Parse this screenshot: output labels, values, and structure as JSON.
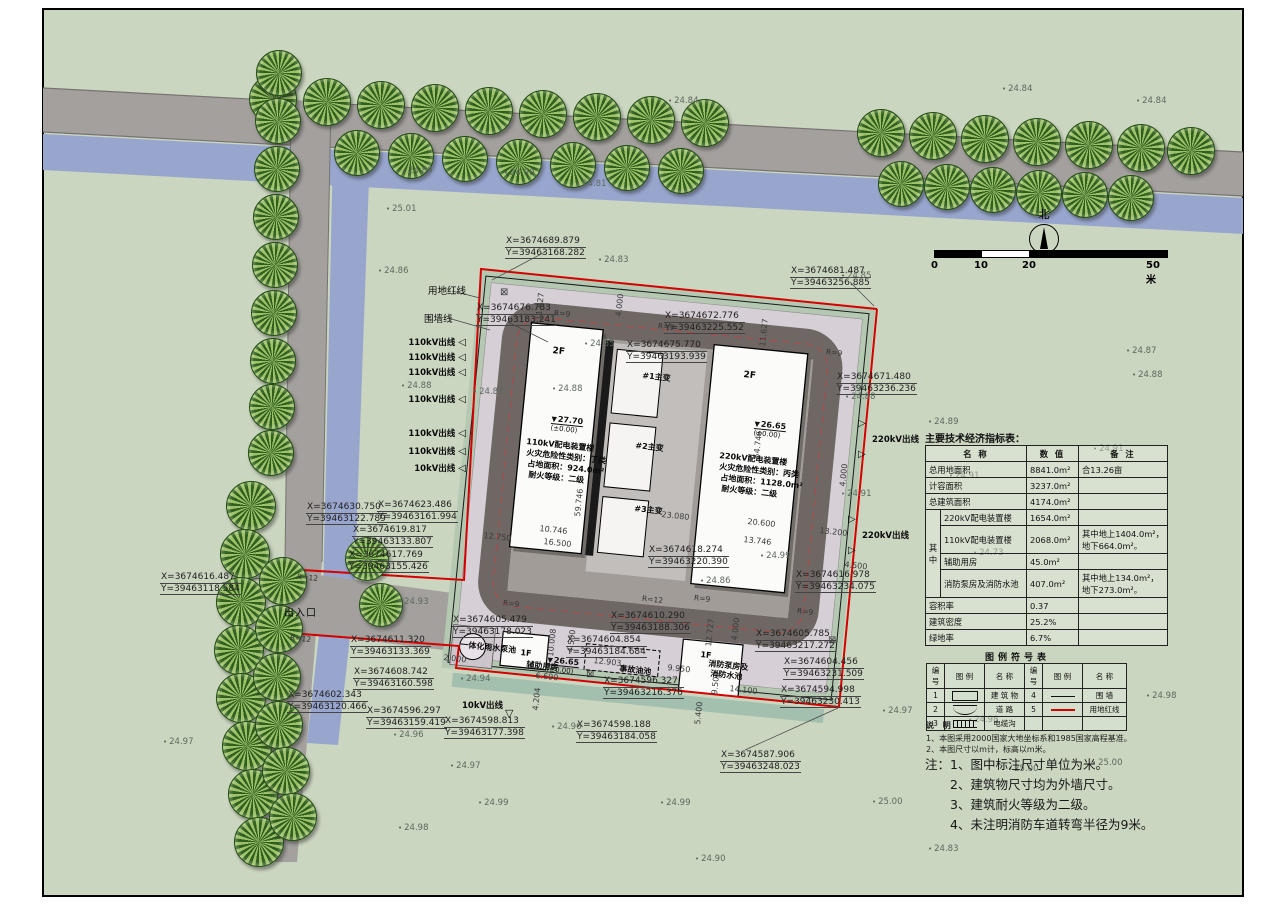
{
  "title": "总平面图",
  "north": {
    "label": "北"
  },
  "scale_bar": {
    "ticks": [
      "0",
      "10",
      "20",
      "50米"
    ]
  },
  "indicator_table": {
    "title": "主要技术经济指标表：",
    "headers": [
      "名  称",
      "数  值",
      "备  注"
    ],
    "group_label": "其中",
    "rows": [
      {
        "name": "总用地面积",
        "value": "8841.0m²",
        "note": "合13.26亩"
      },
      {
        "name": "计容面积",
        "value": "3237.0m²",
        "note": ""
      },
      {
        "name": "总建筑面积",
        "value": "4174.0m²",
        "note": ""
      },
      {
        "name": "220kV配电装置楼",
        "value": "1654.0m²",
        "note": ""
      },
      {
        "name": "110kV配电装置楼",
        "value": "2068.0m²",
        "note": "其中地上1404.0m²，地下664.0m²。"
      },
      {
        "name": "辅助用房",
        "value": "45.0m²",
        "note": ""
      },
      {
        "name": "消防泵房及消防水池",
        "value": "407.0m²",
        "note": "其中地上134.0m²，地下273.0m²。"
      },
      {
        "name": "容积率",
        "value": "0.37",
        "note": ""
      },
      {
        "name": "建筑密度",
        "value": "25.2%",
        "note": ""
      },
      {
        "name": "绿地率",
        "value": "6.7%",
        "note": ""
      }
    ]
  },
  "legend_table": {
    "title": "图例符号表",
    "headers": [
      "编号",
      "图 例",
      "名 称",
      "编号",
      "图 例",
      "名 称"
    ],
    "rows": [
      {
        "no1": "1",
        "sym1": "building-rect",
        "name1": "建 筑 物",
        "no2": "4",
        "sym2": "wall-line",
        "name2": "围 墙"
      },
      {
        "no1": "2",
        "sym1": "road-curves",
        "name1": "道 路",
        "no2": "5",
        "sym2": "red-line",
        "name2": "用地红线"
      },
      {
        "no1": "3",
        "sym1": "cable-trench",
        "name1": "电缆沟",
        "no2": "",
        "sym2": "",
        "name2": ""
      }
    ]
  },
  "notes_small": {
    "title": "说 明",
    "items": [
      "1、本图采用2000国家大地坐标系和1985国家高程基准。",
      "2、本图尺寸以m计，标高以m米。"
    ]
  },
  "notes_big": {
    "prefix": "注：",
    "items": [
      "1、图中标注尺寸单位为米。",
      "2、建筑物尺寸均为外墙尺寸。",
      "3、建筑耐火等级为二级。",
      "4、未注明消防车道转弯半径为9米。"
    ]
  },
  "coords": [
    {
      "x": "X=3674689.879",
      "y": "Y=39463168.282",
      "s": "left:505px;top:236px"
    },
    {
      "x": "X=3674676.783",
      "y": "Y=39463183.241",
      "s": "left:476px;top:303px"
    },
    {
      "x": "X=3674672.776",
      "y": "Y=39463225.552",
      "s": "left:664px;top:311px"
    },
    {
      "x": "X=3674675.770",
      "y": "Y=39463193.939",
      "s": "left:626px;top:340px"
    },
    {
      "x": "X=3674681.487",
      "y": "Y=39463256.885",
      "s": "left:790px;top:266px"
    },
    {
      "x": "X=3674671.480",
      "y": "Y=39463236.236",
      "s": "left:836px;top:372px"
    },
    {
      "x": "X=3674630.750",
      "y": "Y=39463122.789",
      "s": "left:306px;top:502px"
    },
    {
      "x": "X=3674623.486",
      "y": "Y=39463161.994",
      "s": "left:377px;top:500px"
    },
    {
      "x": "X=3674619.817",
      "y": "Y=39463133.807",
      "s": "left:352px;top:525px"
    },
    {
      "x": "X=3674617.769",
      "y": "Y=39463155.426",
      "s": "left:348px;top:550px"
    },
    {
      "x": "X=3674616.487",
      "y": "Y=39463118.584",
      "s": "left:160px;top:572px"
    },
    {
      "x": "X=3674611.320",
      "y": "Y=39463133.369",
      "s": "left:350px;top:635px"
    },
    {
      "x": "X=3674608.742",
      "y": "Y=39463160.598",
      "s": "left:353px;top:667px"
    },
    {
      "x": "X=3674602.343",
      "y": "Y=39463120.466",
      "s": "left:287px;top:690px"
    },
    {
      "x": "X=3674596.297",
      "y": "Y=39463159.419",
      "s": "left:366px;top:706px"
    },
    {
      "x": "X=3674598.813",
      "y": "Y=39463177.398",
      "s": "left:444px;top:716px"
    },
    {
      "x": "X=3674598.188",
      "y": "Y=39463184.058",
      "s": "left:576px;top:720px"
    },
    {
      "x": "X=3674605.479",
      "y": "Y=39463178.023",
      "s": "left:452px;top:615px"
    },
    {
      "x": "X=3674618.274",
      "y": "Y=39463220.390",
      "s": "left:648px;top:545px"
    },
    {
      "x": "X=3674610.290",
      "y": "Y=39463188.306",
      "s": "left:610px;top:611px"
    },
    {
      "x": "X=3674604.854",
      "y": "Y=39463184.684",
      "s": "left:566px;top:635px"
    },
    {
      "x": "X=3674596.327",
      "y": "Y=39463216.376",
      "s": "left:603px;top:676px"
    },
    {
      "x": "X=3674587.906",
      "y": "Y=39463248.023",
      "s": "left:720px;top:750px"
    },
    {
      "x": "X=3674605.785",
      "y": "Y=39463217.272",
      "s": "left:755px;top:629px"
    },
    {
      "x": "X=3674604.456",
      "y": "Y=39463231.509",
      "s": "left:783px;top:657px"
    },
    {
      "x": "X=3674594.998",
      "y": "Y=39463230.413",
      "s": "left:780px;top:685px"
    },
    {
      "x": "X=3674616.978",
      "y": "Y=39463234.075",
      "s": "left:795px;top:570px"
    }
  ],
  "spots": [
    {
      "v": "24.84",
      "s": "left:668px;top:96px"
    },
    {
      "v": "24.84",
      "s": "left:1002px;top:84px"
    },
    {
      "v": "24.84",
      "s": "left:1136px;top:96px"
    },
    {
      "v": "24.89",
      "s": "left:402px;top:166px"
    },
    {
      "v": "24.90",
      "s": "left:504px;top:168px"
    },
    {
      "v": "24.81",
      "s": "left:576px;top:179px"
    },
    {
      "v": "25.01",
      "s": "left:386px;top:204px"
    },
    {
      "v": "24.86",
      "s": "left:378px;top:266px"
    },
    {
      "v": "24.83",
      "s": "left:598px;top:255px"
    },
    {
      "v": "24.85",
      "s": "left:841px;top:271px"
    },
    {
      "v": "24.87",
      "s": "left:1126px;top:346px"
    },
    {
      "v": "24.88",
      "s": "left:1132px;top:370px"
    },
    {
      "v": "24.88",
      "s": "left:845px;top:392px"
    },
    {
      "v": "24.89",
      "s": "left:928px;top:417px"
    },
    {
      "v": "24.88",
      "s": "left:401px;top:381px"
    },
    {
      "v": "24.87",
      "s": "left:473px;top:387px"
    },
    {
      "v": "24.91",
      "s": "left:1093px;top:444px"
    },
    {
      "v": "24.91",
      "s": "left:949px;top:471px"
    },
    {
      "v": "24.73",
      "s": "left:973px;top:548px"
    },
    {
      "v": "24.91",
      "s": "left:841px;top:489px"
    },
    {
      "v": "24.85",
      "s": "left:584px;top:339px"
    },
    {
      "v": "24.88",
      "s": "left:552px;top:384px"
    },
    {
      "v": "24.99",
      "s": "left:760px;top:551px"
    },
    {
      "v": "24.86",
      "s": "left:700px;top:576px"
    },
    {
      "v": "24.93",
      "s": "left:398px;top:597px"
    },
    {
      "v": "24.94",
      "s": "left:460px;top:674px"
    },
    {
      "v": "24.96",
      "s": "left:393px;top:730px"
    },
    {
      "v": "24.96",
      "s": "left:551px;top:722px"
    },
    {
      "v": "24.97",
      "s": "left:450px;top:761px"
    },
    {
      "v": "24.97",
      "s": "left:163px;top:737px"
    },
    {
      "v": "24.98",
      "s": "left:398px;top:823px"
    },
    {
      "v": "24.99",
      "s": "left:478px;top:798px"
    },
    {
      "v": "24.99",
      "s": "left:660px;top:798px"
    },
    {
      "v": "24.90",
      "s": "left:695px;top:854px"
    },
    {
      "v": "24.83",
      "s": "left:928px;top:844px"
    },
    {
      "v": "25.00",
      "s": "left:1008px;top:764px"
    },
    {
      "v": "25.00",
      "s": "left:1092px;top:758px"
    },
    {
      "v": "24.98",
      "s": "left:1146px;top:691px"
    },
    {
      "v": "24.98",
      "s": "left:968px;top:715px"
    },
    {
      "v": "25.00",
      "s": "left:872px;top:797px"
    },
    {
      "v": "24.97",
      "s": "left:882px;top:706px"
    }
  ],
  "dims": [
    {
      "t": "4.000",
      "s": "left:614px;top:316px;transform:rotate(-84deg)"
    },
    {
      "t": "11.627",
      "s": "left:534px;top:320px;transform:rotate(-84deg)"
    },
    {
      "t": "11.627",
      "s": "left:758px;top:346px;transform:rotate(-84deg)"
    },
    {
      "t": "59.746",
      "s": "left:573px;top:516px;transform:rotate(-84deg)"
    },
    {
      "t": "54.746",
      "s": "left:752px;top:458px;transform:rotate(-84deg)"
    },
    {
      "t": "10.746",
      "s": "left:540px;top:524px;transform:rotate(6deg)"
    },
    {
      "t": "16.500",
      "s": "left:544px;top:537px;transform:rotate(6deg)"
    },
    {
      "t": "12.750",
      "s": "left:484px;top:531px;transform:rotate(6deg)"
    },
    {
      "t": "23.080",
      "s": "left:662px;top:510px;transform:rotate(6deg)"
    },
    {
      "t": "20.600",
      "s": "left:748px;top:517px;transform:rotate(6deg)"
    },
    {
      "t": "13.746",
      "s": "left:744px;top:535px;transform:rotate(6deg)"
    },
    {
      "t": "13.200",
      "s": "left:820px;top:526px;transform:rotate(6deg)"
    },
    {
      "t": "4.000",
      "s": "left:838px;top:486px;transform:rotate(-84deg)"
    },
    {
      "t": "12.727",
      "s": "left:704px;top:646px;transform:rotate(-84deg)"
    },
    {
      "t": "4.000",
      "s": "left:730px;top:640px;transform:rotate(-84deg)"
    },
    {
      "t": "4.500",
      "s": "left:845px;top:560px;transform:rotate(6deg)"
    },
    {
      "t": "10.008",
      "s": "left:546px;top:656px;transform:rotate(-84deg)"
    },
    {
      "t": "2.000",
      "s": "left:444px;top:653px;transform:rotate(6deg)"
    },
    {
      "t": "12.903",
      "s": "left:594px;top:656px;transform:rotate(6deg)"
    },
    {
      "t": "6.690",
      "s": "left:536px;top:671px;transform:rotate(6deg)"
    },
    {
      "t": "9.950",
      "s": "left:668px;top:663px;transform:rotate(6deg)"
    },
    {
      "t": "14.100",
      "s": "left:730px;top:684px;transform:rotate(6deg)"
    },
    {
      "t": "9.500",
      "s": "left:710px;top:694px;transform:rotate(-84deg)"
    },
    {
      "t": "5.400",
      "s": "left:693px;top:724px;transform:rotate(-84deg)"
    },
    {
      "t": "4.204",
      "s": "left:531px;top:710px;transform:rotate(-84deg)"
    },
    {
      "t": "4.500",
      "s": "left:566px;top:652px;transform:rotate(-84deg)"
    },
    {
      "t": "⊠",
      "s": "left:500px;top:287px;font-size:10px"
    },
    {
      "t": "⊠",
      "s": "left:586px;top:669px;font-size:10px"
    },
    {
      "t": "⊠",
      "s": "left:828px;top:635px;font-size:10px"
    }
  ],
  "radii": [
    {
      "t": "R=9",
      "s": "left:554px;top:309px"
    },
    {
      "t": "R=9",
      "s": "left:658px;top:322px"
    },
    {
      "t": "R=9",
      "s": "left:826px;top:348px"
    },
    {
      "t": "R=9",
      "s": "left:503px;top:599px"
    },
    {
      "t": "R=9",
      "s": "left:694px;top:594px"
    },
    {
      "t": "R=9",
      "s": "left:797px;top:607px"
    },
    {
      "t": "R=12",
      "s": "left:297px;top:573px"
    },
    {
      "t": "R=12",
      "s": "left:290px;top:634px"
    },
    {
      "t": "R=12",
      "s": "left:642px;top:595px"
    }
  ],
  "outlets_left": [
    {
      "t": "110kV出线",
      "s": "left:390px;top:336px"
    },
    {
      "t": "110kV出线",
      "s": "left:390px;top:351px"
    },
    {
      "t": "110kV出线",
      "s": "left:390px;top:366px"
    },
    {
      "t": "110kV出线",
      "s": "left:390px;top:393px"
    },
    {
      "t": "110kV出线",
      "s": "left:390px;top:427px"
    },
    {
      "t": "110kV出线",
      "s": "left:390px;top:445px"
    },
    {
      "t": "10kV出线",
      "s": "left:390px;top:462px"
    }
  ],
  "outlets_right": [
    {
      "t": "220kV出线",
      "s": "left:872px;top:418px"
    },
    {
      "t": "220kV出线",
      "s": "left:862px;top:514px"
    }
  ],
  "labels": [
    {
      "t": "用地红线",
      "s": "left:428px;top:283px;font-size:9.5px"
    },
    {
      "t": "围墙线",
      "s": "left:424px;top:311px;font-size:9.5px"
    },
    {
      "t": "出入口",
      "s": "left:284px;top:604px;font-size:10px;letter-spacing:1px"
    },
    {
      "t": "10kV出线",
      "s": "left:462px;top:699px;font-weight:700;font-size:8.5px"
    },
    {
      "t": "▽",
      "s": "left:505px;top:707px;font-size:11px"
    },
    {
      "t": "110kV配电装置楼",
      "s": "left:527px;top:436px;font-size:8px;font-weight:700;transform:rotate(6deg)"
    },
    {
      "t": "火灾危险性类别：丁类",
      "s": "left:527px;top:447px;font-size:8px;font-weight:700;transform:rotate(6deg)"
    },
    {
      "t": "占地面积：924.0m²",
      "s": "left:528px;top:458px;font-size:8px;font-weight:700;transform:rotate(6deg)"
    },
    {
      "t": "耐火等级：二级",
      "s": "left:529px;top:469px;font-size:8px;font-weight:700;transform:rotate(6deg)"
    },
    {
      "t": "220kV配电装置楼",
      "s": "left:720px;top:450px;font-size:8px;font-weight:700;transform:rotate(6deg)"
    },
    {
      "t": "火灾危险性类别：丙类",
      "s": "left:720px;top:461px;font-size:8px;font-weight:700;transform:rotate(6deg)"
    },
    {
      "t": "占地面积：1128.0m²",
      "s": "left:721px;top:472px;font-size:8px;font-weight:700;transform:rotate(6deg)"
    },
    {
      "t": "耐火等级：二级",
      "s": "left:722px;top:483px;font-size:8px;font-weight:700;transform:rotate(6deg)"
    },
    {
      "t": "2F",
      "s": "left:553px;top:346px;font-size:9px;font-weight:700;transform:rotate(6deg)"
    },
    {
      "t": "2F",
      "s": "left:744px;top:370px;font-size:9px;font-weight:700;transform:rotate(6deg)"
    },
    {
      "t": "1F",
      "s": "left:521px;top:648px;font-size:8px;font-weight:700;transform:rotate(6deg)"
    },
    {
      "t": "1F",
      "s": "left:701px;top:650px;font-size:8px;font-weight:700;transform:rotate(6deg)"
    },
    {
      "t": "#1主变",
      "s": "left:643px;top:370px;font-size:8px;font-weight:700;transform:rotate(6deg)"
    },
    {
      "t": "#2主变",
      "s": "left:636px;top:440px;font-size:8px;font-weight:700;transform:rotate(6deg)"
    },
    {
      "t": "#3主变",
      "s": "left:635px;top:503px;font-size:8px;font-weight:700;transform:rotate(6deg)"
    },
    {
      "t": "一体化雨水泵池",
      "s": "left:461px;top:639px;font-size:8px;font-weight:700;transform:rotate(6deg)"
    },
    {
      "t": "辅助用房",
      "s": "left:527px;top:659px;font-size:8px;font-weight:700;transform:rotate(6deg)"
    },
    {
      "t": "事故油池",
      "s": "left:620px;top:663px;font-size:8px;font-weight:700;transform:rotate(6deg)"
    },
    {
      "t": "消防泵房及",
      "s": "left:709px;top:658px;font-size:8px;font-weight:700;transform:rotate(6deg)"
    },
    {
      "t": "消防水池",
      "s": "left:711px;top:668px;font-size:8px;font-weight:700;transform:rotate(6deg)"
    }
  ],
  "elevations": [
    {
      "v": "27.70",
      "b": "(±0.00)",
      "s": "left:552px;top:414px"
    },
    {
      "v": "26.65",
      "b": "(±0.00)",
      "s": "left:755px;top:419px"
    },
    {
      "v": "26.65",
      "b": "(±0.00)",
      "s": "left:548px;top:655px"
    }
  ],
  "trees": [
    [
      272,
      98,
      46
    ],
    [
      326,
      101,
      46
    ],
    [
      380,
      104,
      46
    ],
    [
      434,
      107,
      46
    ],
    [
      488,
      110,
      46
    ],
    [
      542,
      113,
      46
    ],
    [
      596,
      116,
      46
    ],
    [
      650,
      119,
      46
    ],
    [
      704,
      122,
      46
    ],
    [
      880,
      132,
      46
    ],
    [
      932,
      135,
      46
    ],
    [
      984,
      138,
      46
    ],
    [
      1036,
      141,
      46
    ],
    [
      1088,
      144,
      46
    ],
    [
      1140,
      147,
      46
    ],
    [
      1190,
      150,
      46
    ],
    [
      356,
      152,
      44
    ],
    [
      410,
      155,
      44
    ],
    [
      464,
      158,
      44
    ],
    [
      518,
      161,
      44
    ],
    [
      572,
      164,
      44
    ],
    [
      626,
      167,
      44
    ],
    [
      680,
      170,
      44
    ],
    [
      900,
      183,
      44
    ],
    [
      946,
      186,
      44
    ],
    [
      992,
      189,
      44
    ],
    [
      1038,
      192,
      44
    ],
    [
      1084,
      194,
      44
    ],
    [
      1130,
      197,
      44
    ],
    [
      278,
      72,
      44
    ],
    [
      277,
      120,
      44
    ],
    [
      276,
      168,
      44
    ],
    [
      275,
      216,
      44
    ],
    [
      274,
      264,
      44
    ],
    [
      273,
      312,
      44
    ],
    [
      272,
      360,
      44
    ],
    [
      271,
      406,
      44
    ],
    [
      270,
      452,
      44
    ],
    [
      250,
      505,
      48
    ],
    [
      244,
      553,
      48
    ],
    [
      240,
      601,
      48
    ],
    [
      238,
      649,
      48
    ],
    [
      240,
      697,
      48
    ],
    [
      246,
      745,
      48
    ],
    [
      252,
      793,
      48
    ],
    [
      258,
      841,
      48
    ],
    [
      282,
      580,
      46
    ],
    [
      278,
      628,
      46
    ],
    [
      276,
      676,
      46
    ],
    [
      278,
      724,
      46
    ],
    [
      285,
      770,
      46
    ],
    [
      292,
      816,
      46
    ],
    [
      366,
      558,
      42
    ],
    [
      380,
      604,
      42
    ]
  ]
}
